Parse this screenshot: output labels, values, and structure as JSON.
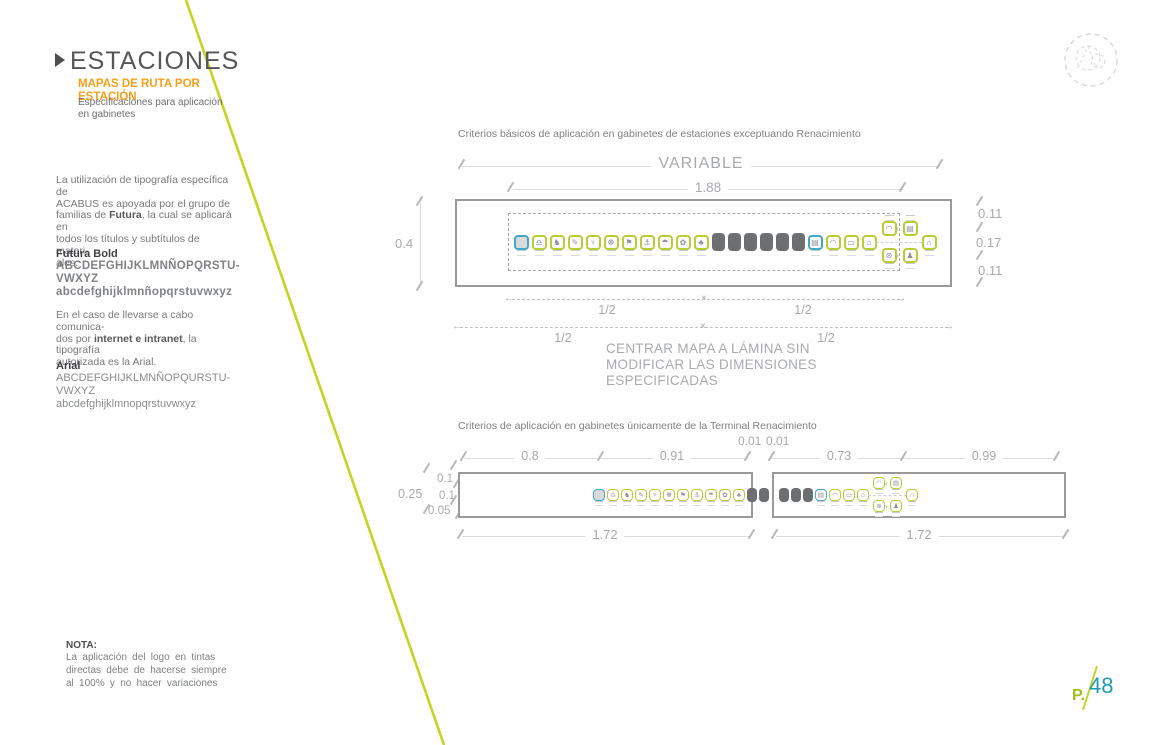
{
  "header": {
    "title": "ESTACIONES",
    "subtitle_line1": "MAPAS DE RUTA POR",
    "subtitle_line2": "ESTACIÓN",
    "description_line1": "Especificaciones para aplicación",
    "description_line2": "en gabinetes"
  },
  "typography": {
    "intro_lines": [
      [
        "La utilización de tipografía específica de"
      ],
      [
        "ACABUS es apoyada por el grupo de"
      ],
      [
        "familias de ",
        {
          "b": "Futura"
        },
        ", la cual se aplicará en"
      ],
      [
        "todos los títulos y subtítulos de materi-"
      ],
      [
        "ales."
      ]
    ],
    "futura_heading": "Futura Bold",
    "futura_upper_1": "ABCDEFGHIJKLMNÑOPQRSTU-",
    "futura_upper_2": "VWXYZ",
    "futura_lower": "abcdefghijklmnñopqrstuvwxyz",
    "web_lines": [
      [
        "En el caso de llevarse a cabo comunica-"
      ],
      [
        "dos por ",
        {
          "b": "internet e intranet"
        },
        ", la tipografía"
      ],
      [
        "autorizada es la Arial."
      ]
    ],
    "arial_heading": "Arial",
    "arial_upper_1": "ABCDEFGHIJKLMNÑOPQURSTU-",
    "arial_upper_2": "VWXYZ",
    "arial_lower": "abcdefghijklmnopqrstuvwxyz"
  },
  "diagram1": {
    "caption": "Criterios básicos de aplicación en gabinetes de estaciones exceptuando Renacimiento",
    "dim_variable": "VARIABLE",
    "dim_width": "1.88",
    "dim_height": "0.4",
    "dims_right": [
      "0.11",
      "0.17",
      "0.11"
    ],
    "half_labels": [
      "1/2",
      "1/2",
      "1/2",
      "1/2"
    ],
    "note_lines": [
      "CENTRAR MAPA A LÁMINA SIN",
      "MODIFICAR LAS DIMENSIONES",
      "ESPECIFICADAS"
    ],
    "strip": [
      {
        "name": "zocalo-terminal-icon",
        "type": "blue fill",
        "glyph": ""
      },
      {
        "name": "scales-station-icon",
        "type": "green",
        "glyph": "♎"
      },
      {
        "name": "owl-station-icon",
        "type": "green",
        "glyph": "♞"
      },
      {
        "name": "pen-station-icon",
        "type": "green",
        "glyph": "✎"
      },
      {
        "name": "boat-station-icon",
        "type": "green",
        "glyph": "♆"
      },
      {
        "name": "windmill-station-icon",
        "type": "green",
        "glyph": "☸"
      },
      {
        "name": "flag-station-icon",
        "type": "green",
        "glyph": "⚑"
      },
      {
        "name": "anchor-station-icon",
        "type": "green",
        "glyph": "⚓"
      },
      {
        "name": "hook-station-icon",
        "type": "green",
        "glyph": "☂"
      },
      {
        "name": "leaf-station-icon",
        "type": "green",
        "glyph": "✿"
      },
      {
        "name": "tree-station-icon",
        "type": "green",
        "glyph": "♣"
      },
      {
        "name": "intermediate-station-icon",
        "type": "dark",
        "glyph": ""
      },
      {
        "name": "intermediate-station-icon",
        "type": "dark",
        "glyph": ""
      },
      {
        "name": "intermediate-station-icon",
        "type": "dark",
        "glyph": ""
      },
      {
        "name": "intermediate-station-icon",
        "type": "dark",
        "glyph": ""
      },
      {
        "name": "intermediate-station-icon",
        "type": "dark",
        "glyph": ""
      },
      {
        "name": "intermediate-station-icon",
        "type": "dark",
        "glyph": ""
      },
      {
        "name": "renacimiento-terminal-icon",
        "type": "blue nofill",
        "glyph": "▤"
      },
      {
        "name": "car-station-icon",
        "type": "green",
        "glyph": "◠"
      },
      {
        "name": "screen-station-icon",
        "type": "green",
        "glyph": "▭"
      },
      {
        "name": "suitcase-station-icon",
        "type": "green",
        "glyph": "⌂"
      }
    ],
    "cluster": [
      {
        "name": "bus-branch-icon",
        "glyph": "◠"
      },
      {
        "name": "building-branch-icon",
        "glyph": "▤"
      },
      {
        "name": "wheel-branch-icon",
        "glyph": "⊛"
      },
      {
        "name": "tree-branch-icon",
        "glyph": "♟"
      }
    ],
    "return_icon": {
      "name": "return-loop-icon",
      "type": "green",
      "glyph": "∩"
    }
  },
  "diagram2": {
    "caption": "Criterios de aplicación en gabinetes únicamente de la Terminal Renacimiento",
    "top_dims": [
      "0.8",
      "0.91",
      "0.73",
      "0.99"
    ],
    "small_dims": [
      "0.01",
      "0.01"
    ],
    "left_outer_dim": "0.25",
    "left_inner_dims": [
      "0.1",
      "0.1",
      "0.05"
    ],
    "bottom_dims": [
      "1.72",
      "1.72"
    ],
    "left_strip": [
      {
        "name": "zocalo-terminal-icon",
        "type": "blue fill",
        "glyph": ""
      },
      {
        "name": "scales-station-icon",
        "type": "green",
        "glyph": "♎"
      },
      {
        "name": "owl-station-icon",
        "type": "green",
        "glyph": "♞"
      },
      {
        "name": "pen-station-icon",
        "type": "green",
        "glyph": "✎"
      },
      {
        "name": "boat-station-icon",
        "type": "green",
        "glyph": "♆"
      },
      {
        "name": "windmill-station-icon",
        "type": "green",
        "glyph": "☸"
      },
      {
        "name": "flag-station-icon",
        "type": "green",
        "glyph": "⚑"
      },
      {
        "name": "anchor-station-icon",
        "type": "green",
        "glyph": "⚓"
      },
      {
        "name": "hook-station-icon",
        "type": "green",
        "glyph": "☂"
      },
      {
        "name": "leaf-station-icon",
        "type": "green",
        "glyph": "✿"
      },
      {
        "name": "tree-station-icon",
        "type": "green",
        "glyph": "♣"
      },
      {
        "name": "intermediate-station-icon",
        "type": "dark",
        "glyph": ""
      },
      {
        "name": "intermediate-station-icon",
        "type": "dark",
        "glyph": ""
      }
    ],
    "right_strip": [
      {
        "name": "intermediate-station-icon",
        "type": "dark",
        "glyph": ""
      },
      {
        "name": "intermediate-station-icon",
        "type": "dark",
        "glyph": ""
      },
      {
        "name": "intermediate-station-icon",
        "type": "dark",
        "glyph": ""
      },
      {
        "name": "renacimiento-terminal-icon",
        "type": "blue nofill",
        "glyph": "▤"
      },
      {
        "name": "car-station-icon",
        "type": "green",
        "glyph": "◠"
      },
      {
        "name": "screen-station-icon",
        "type": "green",
        "glyph": "▭"
      },
      {
        "name": "suitcase-station-icon",
        "type": "green",
        "glyph": "⌂"
      }
    ],
    "cluster": [
      {
        "name": "bus-branch-icon",
        "glyph": "◠"
      },
      {
        "name": "building-branch-icon",
        "glyph": "▤"
      },
      {
        "name": "wheel-branch-icon",
        "glyph": "⊛"
      },
      {
        "name": "tree-branch-icon",
        "glyph": "♟"
      }
    ],
    "return_icon": {
      "name": "return-loop-icon",
      "type": "green",
      "glyph": "∩"
    }
  },
  "nota": {
    "heading": "NOTA:",
    "lines": [
      [
        "La aplicación del logo en tintas"
      ],
      [
        "directas debe de hacerse siempre"
      ],
      [
        "al 100% y no hacer variaciones"
      ]
    ]
  },
  "footer": {
    "page_prefix": "P.",
    "page_number": "48"
  },
  "colors": {
    "accent_green": "#c5d420",
    "icon_green": "#b9cc34",
    "icon_blue": "#3fa8c8",
    "orange": "#f6a01a",
    "teal": "#1d9cb5"
  }
}
